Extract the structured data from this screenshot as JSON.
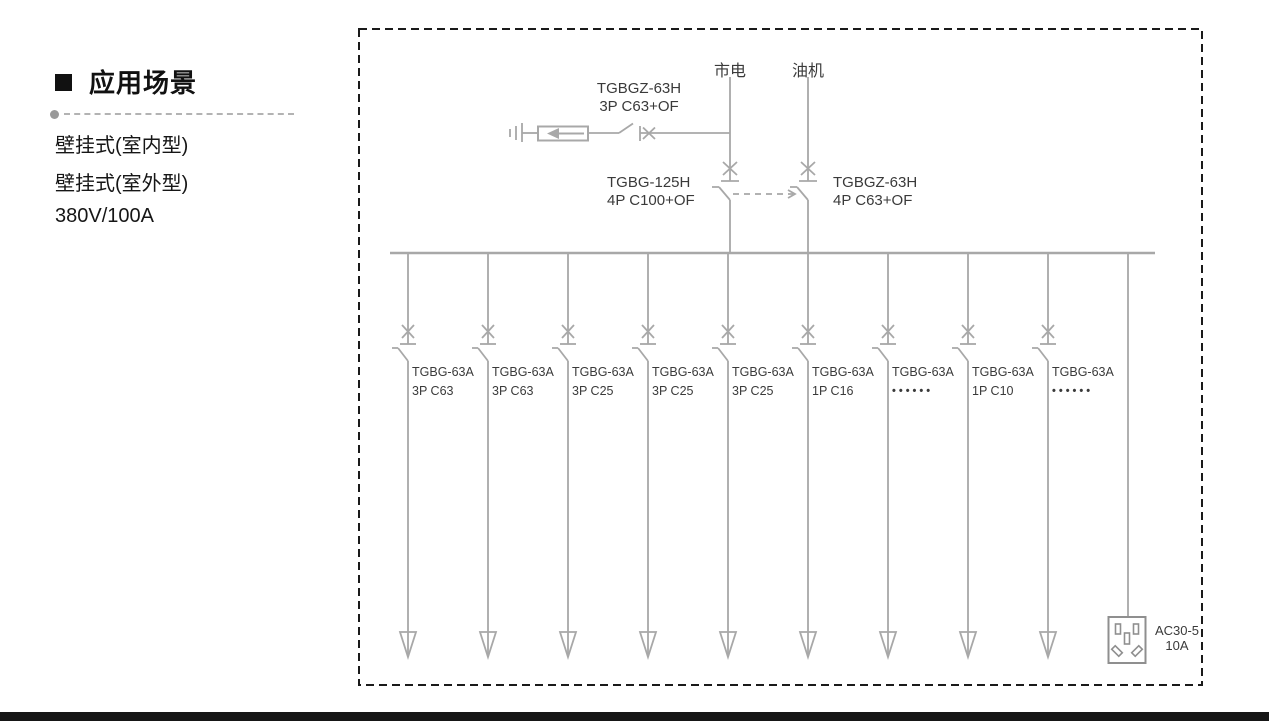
{
  "sidebar": {
    "heading": "应用场景",
    "features": [
      "壁挂式(室内型)",
      "壁挂式(室外型)",
      "380V/100A"
    ]
  },
  "diagram": {
    "source_left": "市电",
    "source_right": "油机",
    "spd_breaker": {
      "model": "TGBGZ-63H",
      "spec": "3P C63+OF"
    },
    "main_breaker": {
      "model": "TGBG-125H",
      "spec": "4P C100+OF"
    },
    "gen_breaker": {
      "model": "TGBGZ-63H",
      "spec": "4P C63+OF"
    },
    "branches": [
      {
        "model": "TGBG-63A",
        "spec": "3P C63"
      },
      {
        "model": "TGBG-63A",
        "spec": "3P C63"
      },
      {
        "model": "TGBG-63A",
        "spec": "3P C25"
      },
      {
        "model": "TGBG-63A",
        "spec": "3P C25"
      },
      {
        "model": "TGBG-63A",
        "spec": "3P C25"
      },
      {
        "model": "TGBG-63A",
        "spec": "1P C16"
      },
      {
        "model": "TGBG-63A",
        "spec": "••••••"
      },
      {
        "model": "TGBG-63A",
        "spec": "1P C10"
      },
      {
        "model": "TGBG-63A",
        "spec": "••••••"
      }
    ],
    "socket": {
      "model": "AC30-5",
      "rating": "10A"
    },
    "colors": {
      "line": "#a8a8a8",
      "text": "#3a3a3a",
      "border": "#1a1a1a"
    }
  }
}
